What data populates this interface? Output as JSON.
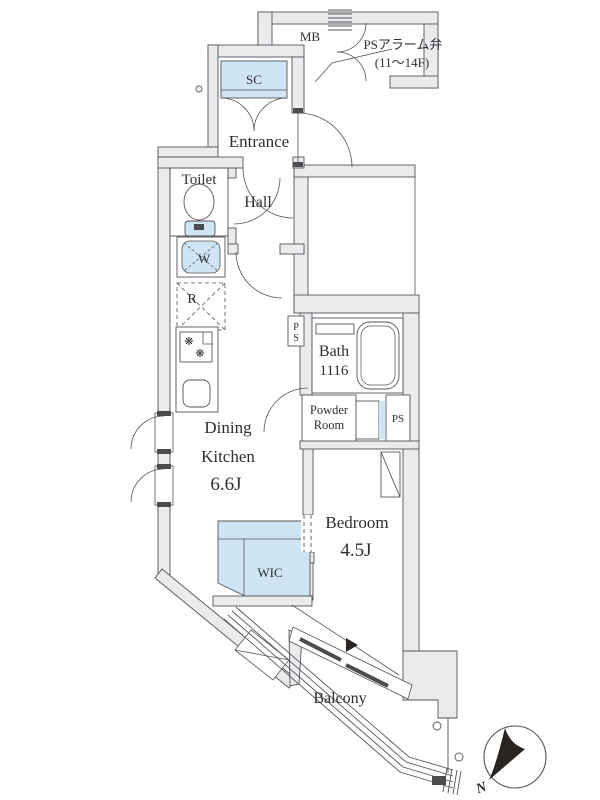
{
  "plan_title": "apartment-floor-plan",
  "rooms": {
    "mb": "MB",
    "sc": "SC",
    "entrance": "Entrance",
    "toilet": "Toilet",
    "hall": "Hall",
    "washer": "W",
    "fridge": "R",
    "ps_shaft_p": "P",
    "ps_shaft_s": "S",
    "bath": "Bath",
    "bath_size": "1116",
    "powder_line1": "Powder",
    "powder_line2": "Room",
    "ps_right": "PS",
    "dining": "Dining",
    "kitchen": "Kitchen",
    "dk_size": "6.6J",
    "bedroom": "Bedroom",
    "bedroom_size": "4.5J",
    "wic": "WIC",
    "balcony": "Balcony"
  },
  "annotations": {
    "alarm_valve": "PSアラーム弁",
    "alarm_floors": "(11〜14F)",
    "north": "N"
  },
  "colors": {
    "wall_fill": "#eaebed",
    "line": "#54555a",
    "closet_fill": "#cfe5f3",
    "fixture_dark": "#4a4c4e",
    "needle": "#2b2522"
  }
}
